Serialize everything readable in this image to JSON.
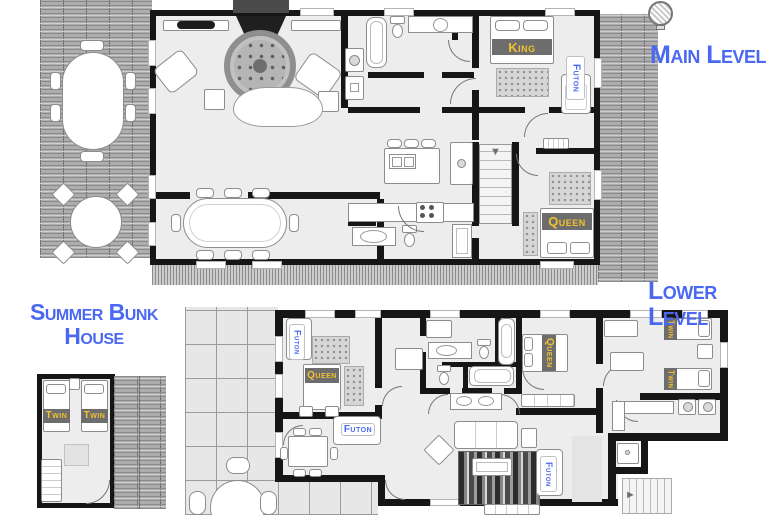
{
  "titles": {
    "main": "Main Level",
    "lower": "Lower Level",
    "bunk_line1": "Summer Bunk",
    "bunk_line2": "House"
  },
  "beds": {
    "main_king": "King",
    "main_futon": "Futon",
    "main_queen": "Queen",
    "lower_futon_nook": "Futon",
    "lower_queen_west": "Queen",
    "lower_queen_east": "Queen",
    "lower_futon_den": "Futon",
    "lower_futon_living": "Futon",
    "lower_twin_north": "Twin",
    "lower_twin_south": "Twin",
    "bunk_twin_left": "Twin",
    "bunk_twin_right": "Twin"
  },
  "icons": {
    "stairs_down_arrow": "▼",
    "stairs_right_arrow": "►",
    "grill_icon": "circle-hatch"
  },
  "colors": {
    "title_blue": "#4a68f2",
    "futon_label_blue": "#4a68f2",
    "bed_label_yellow": "#f1c12f",
    "bed_banner_gray": "#6d6d6d",
    "wall_black": "#161616",
    "floor_gray": "#ededed",
    "deck_gray": "#adadad",
    "patio_tile_gray": "#e7e7e7"
  }
}
